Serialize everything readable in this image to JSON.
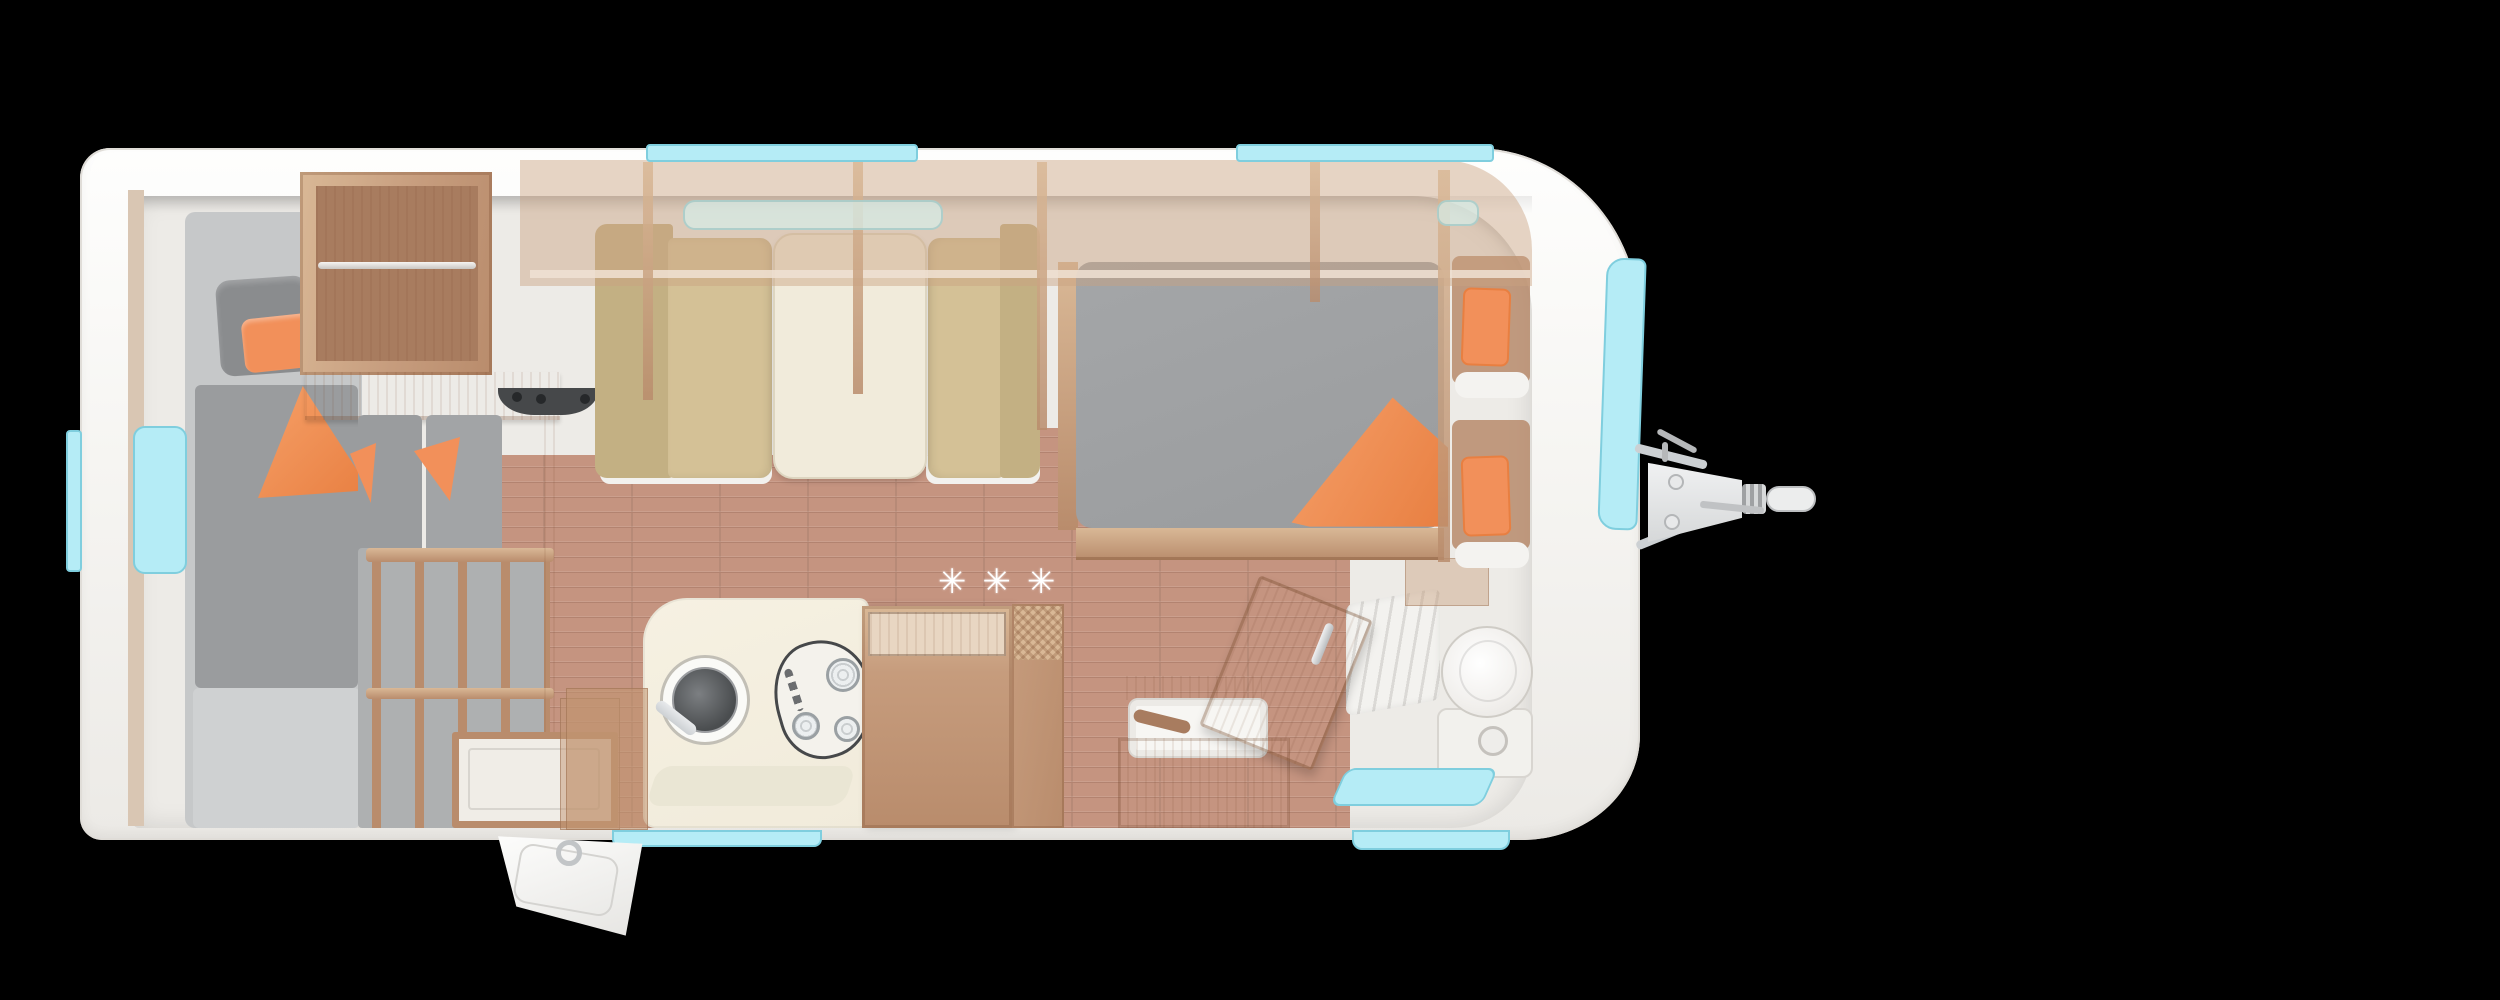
{
  "scene": {
    "description": "caravan-floorplan-top-view",
    "background": "#000000"
  },
  "floor": {
    "decoration_stars": "✳✳✳"
  },
  "colors": {
    "black": "#000000",
    "shell": "#f6f5f2",
    "shell_edge": "#e0ddd8",
    "interior": "#edebe7",
    "wall_tan": "#d9c6b3",
    "wood": "#c69c7d",
    "wood_mid": "#b98c6c",
    "wood_dark": "#a87c5f",
    "wood_light": "#d9b896",
    "wood_pale": "#e8d6c2",
    "floor": "#c59480",
    "floor_seam": "#aa7560",
    "mattress_light": "#c6c8c9",
    "mattress": "#9a9c9e",
    "pillow_gray": "#8a8c8e",
    "orange": "#f2905a",
    "orange_deep": "#e87f41",
    "bench": "#d4c196",
    "bench_dark": "#c3b083",
    "cream": "#f1ebdb",
    "cyan": "#b5ecf6",
    "cyan_edge": "#7fcede",
    "white": "#fbfbfa",
    "appliance_dark": "#46484a",
    "chrome": "#ccd0d3",
    "locker_tint": "rgba(202,162,129,0.45)",
    "glass": "rgba(213,235,230,0.75)"
  }
}
